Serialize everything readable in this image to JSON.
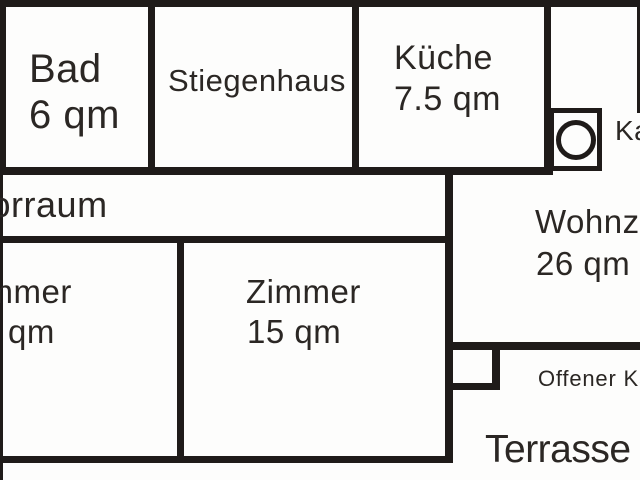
{
  "colors": {
    "background": "#fdfdfc",
    "walls": "#1f1b19",
    "text": "#2b2724"
  },
  "rooms": {
    "bad": {
      "name": "Bad",
      "area": "6 qm"
    },
    "stiegenhaus": {
      "name": "Stiegenhaus"
    },
    "kueche": {
      "name": "Küche",
      "area": "7.5 qm"
    },
    "vorraum": {
      "name": "Vorraum"
    },
    "zimmer_left": {
      "name": "Zimmer",
      "area": "qm"
    },
    "zimmer": {
      "name": "Zimmer",
      "area": "15 qm"
    },
    "wohnzimmer": {
      "name": "Wohnzimmer",
      "area": "26 qm"
    }
  },
  "features": {
    "kachelofen": {
      "label": "Kachelofen"
    },
    "offener_kamin": {
      "label": "Offener Kamin"
    },
    "terrasse": {
      "label": "Terrasse"
    }
  }
}
